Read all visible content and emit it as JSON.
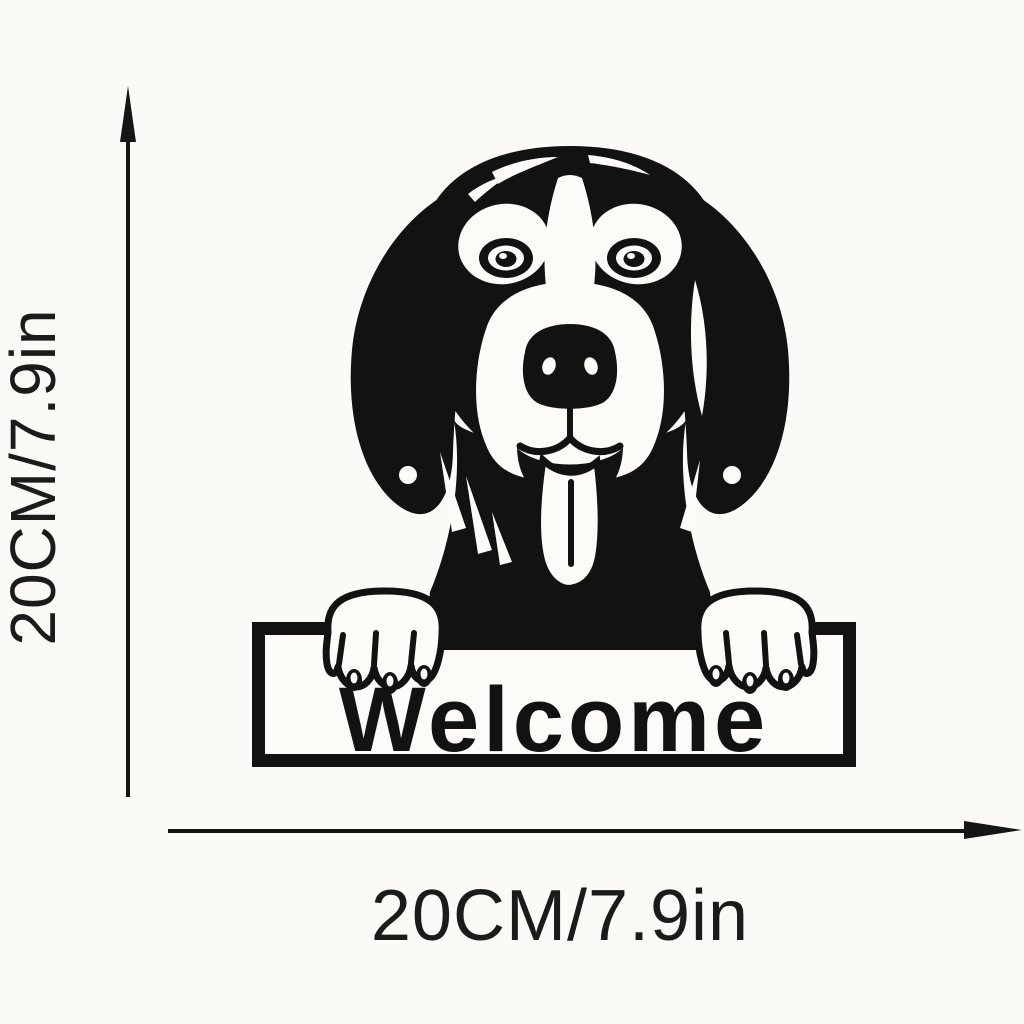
{
  "page": {
    "background_color": "#fbfaf7",
    "artwork_color": "#121212"
  },
  "artwork": {
    "subject": "peeking-hound-dog-silhouette",
    "sign_text": "Welcome"
  },
  "dimensions": {
    "vertical": {
      "label": "20CM/7.9in"
    },
    "horizontal": {
      "label": "20CM/7.9in"
    }
  }
}
